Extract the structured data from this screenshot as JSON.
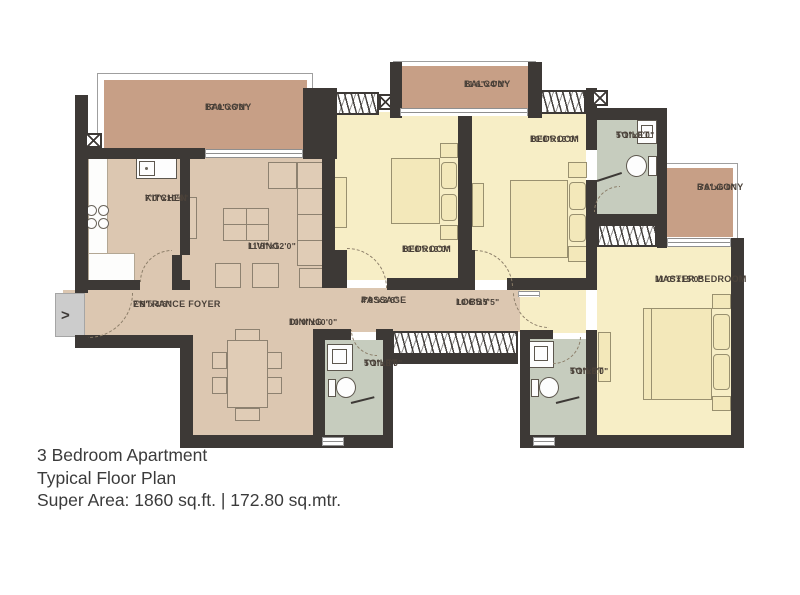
{
  "rooms": {
    "balcony_tl": {
      "name": "BALCONY",
      "dims": "17'0\"x6'0\""
    },
    "balcony_tm": {
      "name": "BALCONY",
      "dims": "11'6\"x4'0\""
    },
    "balcony_r": {
      "name": "BALCONY",
      "dims": "5'6\"x6'0\""
    },
    "kitchen": {
      "name": "KITCHEN",
      "dims": "7'0\"x10'0\""
    },
    "living": {
      "name": "LIVING",
      "dims": "11'8\"x12'0\""
    },
    "entrance_foyer": {
      "name": "ENTRANCE FOYER",
      "dims": "7'9\"x4'6\""
    },
    "dining": {
      "name": "DINING",
      "dims": "10'0\"x10'0\""
    },
    "passage": {
      "name": "PASSAGE",
      "dims": "4'9\"x3'6\""
    },
    "lobby": {
      "name": "LOBBY",
      "dims": "10'6\"x5'5\""
    },
    "bedroom1": {
      "name": "BEDROOM",
      "dims": "10'0\"x13'0\""
    },
    "bedroom2": {
      "name": "BEDROOM",
      "dims": "10'0\"x13'0\""
    },
    "master_bedroom": {
      "name": "MASTER BEDROOM",
      "dims": "11'0\"x15'0\""
    },
    "toilet_top": {
      "name": "TOILET",
      "dims": "5'1\"x8'0\""
    },
    "toilet_bl": {
      "name": "TOILET",
      "dims": "5'1\"x8'0\""
    },
    "toilet_bm": {
      "name": "TOILET",
      "dims": "5'1\"x8'0\""
    }
  },
  "entry": {
    "arrow": ">"
  },
  "title_block": {
    "line1": "3 Bedroom Apartment",
    "line2": "Typical Floor Plan",
    "line3": "Super Area: 1860 sq.ft. |  172.80 sq.mtr."
  }
}
